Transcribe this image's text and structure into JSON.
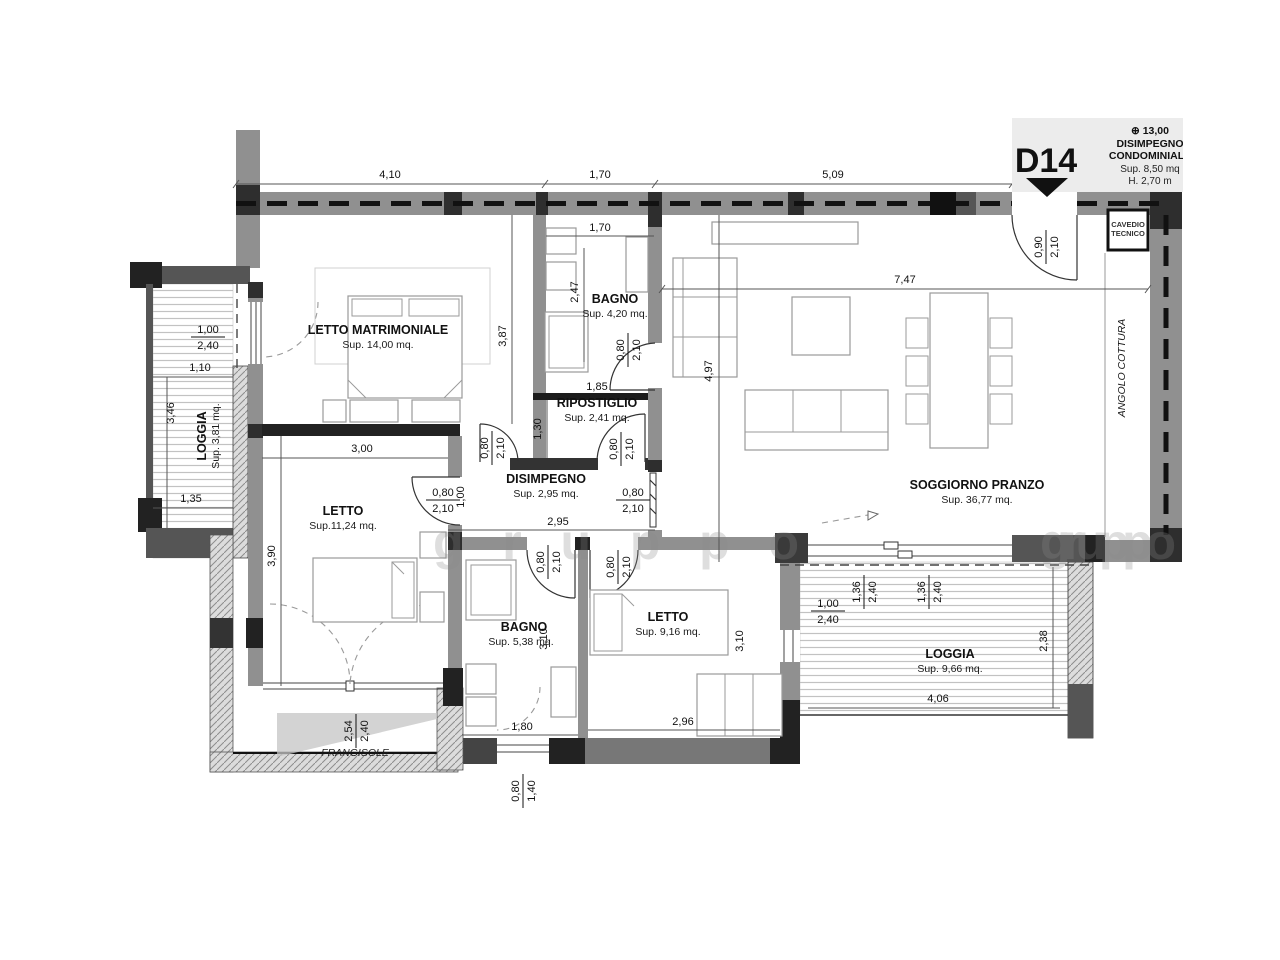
{
  "title_block": {
    "unit": "D14",
    "elevation": "⊕ 13,00",
    "line1": "DISIMPEGNO",
    "line2": "CONDOMINIALE",
    "area": "Sup. 8,50 mq",
    "height": "H. 2,70 m"
  },
  "rooms": {
    "letto_matrimoniale": {
      "name": "LETTO MATRIMONIALE",
      "area": "Sup. 14,00 mq."
    },
    "bagno1": {
      "name": "BAGNO",
      "area": "Sup. 4,20 mq."
    },
    "ripostiglio": {
      "name": "RIPOSTIGLIO",
      "area": "Sup. 2,41 mq."
    },
    "disimpegno": {
      "name": "DISIMPEGNO",
      "area": "Sup. 2,95 mq."
    },
    "soggiorno": {
      "name": "SOGGIORNO PRANZO",
      "area": "Sup. 36,77 mq."
    },
    "letto2": {
      "name": "LETTO",
      "area": "Sup.11,24 mq."
    },
    "bagno2": {
      "name": "BAGNO",
      "area": "Sup. 5,38 mq."
    },
    "letto3": {
      "name": "LETTO",
      "area": "Sup. 9,16 mq."
    },
    "loggia_left": {
      "name": "LOGGIA",
      "area": "Sup. 3,81 mq."
    },
    "loggia_right": {
      "name": "LOGGIA",
      "area": "Sup. 9,66 mq."
    },
    "cavedio": {
      "line1": "CAVEDIO",
      "line2": "TECNICO"
    },
    "angolo_cottura": "ANGOLO COTTURA",
    "frangisole": "FRANGISOLE"
  },
  "dims": {
    "d410": "4,10",
    "d170": "1,70",
    "d509": "5,09",
    "d247": "2,47",
    "d387": "3,87",
    "d185": "1,85",
    "d130": "1,30",
    "d080": "0,80",
    "d210": "2,10",
    "d090": "0,90",
    "d100": "1,00",
    "d110": "1,10",
    "d135": "1,35",
    "d136": "1,36",
    "d140": "1,40",
    "d180": "1,80",
    "d238": "2,38",
    "d240": "2,40",
    "d254": "2,54",
    "d295": "2,95",
    "d296": "2,96",
    "d300": "3,00",
    "d310": "3,10",
    "d346": "3,46",
    "d390": "3,90",
    "d406": "4,06",
    "d497": "4,97",
    "d747": "7,47"
  },
  "watermark": "gruppo",
  "colors": {
    "wall": "#909090",
    "column": "#2e2e2e",
    "titlebox": "#ececec"
  }
}
